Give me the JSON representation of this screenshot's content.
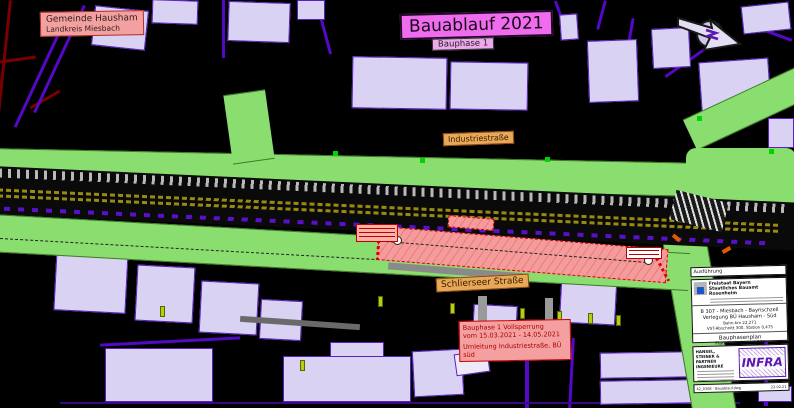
{
  "labels": {
    "municipality_line1": "Gemeinde Hausham",
    "municipality_line2": "Landkreis Miesbach",
    "plan_title": "Bauablauf 2021",
    "plan_subtitle": "Bauphase 1",
    "street_top": "Industriestraße",
    "street_bottom": "Schlierseer Straße",
    "closure_note_line1": "Bauphase 1 Vollsperrung",
    "closure_note_line2": "vom 15.03.2021 - 14.05.2021",
    "closure_note_line3": "Umleitung Industriestraße, BÜ süd"
  },
  "title_block": {
    "header": "Ausführung",
    "agency_line1": "Freistaat Bayern",
    "agency_line2": "Staatliches Bauamt Rosenheim",
    "route": "B 307 - Miesbach - Bayrischzell",
    "project": "Verlegung BÜ Hausham - Süd",
    "detail_line1": "Bahn-km 22,271",
    "detail_line2": "VST-Abschnitt 300, Station 0,475",
    "plan_type": "Bauphasenplan",
    "scale": "Planabschnitt  M 1:500",
    "firm_line1": "HANSEL, STEINER &",
    "firm_line2": "PARTNER INGENIEURE",
    "firm_logo": "INFRA",
    "file_name": "42_0308 - Bauablauf.dwg",
    "file_date": "22.02.21"
  },
  "icons": {
    "north_arrow": "north-arrow-icon"
  },
  "colors": {
    "background": "#000000",
    "road_green": "#8ade70",
    "building_fill": "#d9d2f2",
    "building_border": "#5a20c0",
    "construction_pink": "#f49c9c",
    "construction_red": "#d40000",
    "label_tan": "#e8a85a",
    "title_magenta": "#ee6ced",
    "note_salmon": "#f5a0a0",
    "railway_olive": "#9a8a10",
    "parcel_purple": "#5408c8"
  }
}
